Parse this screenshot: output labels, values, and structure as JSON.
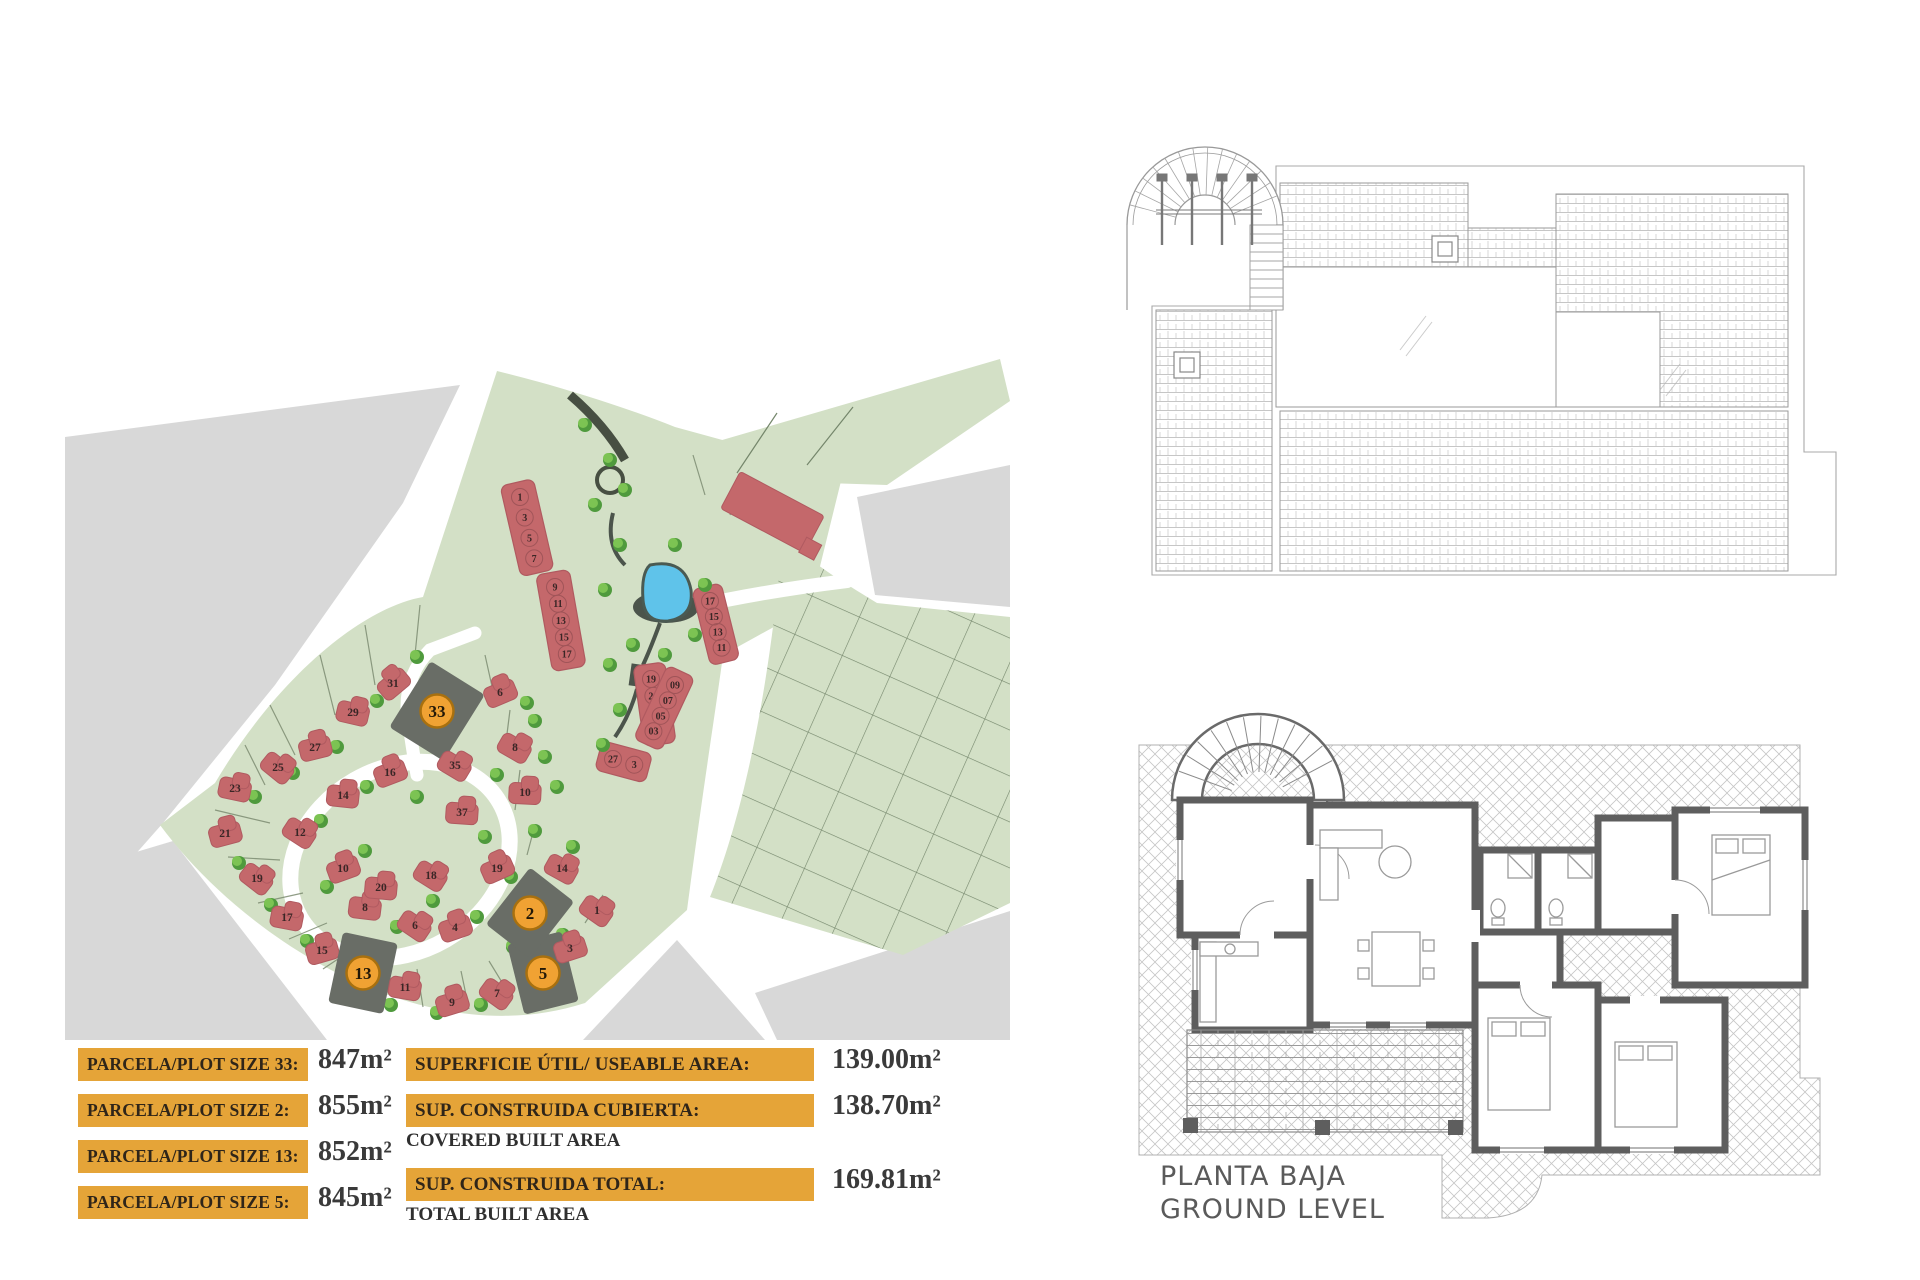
{
  "page": {
    "background": "#ffffff"
  },
  "site_plan": {
    "colors": {
      "green": "#d3e0c6",
      "gray": "#d8d8d8",
      "road": "#ffffff",
      "house": "#c4686b",
      "house_edge": "#b05a60",
      "tree_dark": "#4f9a3d",
      "tree_light": "#7cc353",
      "pond": "#5fc3ea",
      "pond_rim": "#4b544b",
      "dark_plot": "#696d66",
      "marker": "#f0a233",
      "marker_border": "#a8700f",
      "parcel_line": "#7d8c72"
    },
    "highlighted_plots": [
      "33",
      "2",
      "13",
      "5"
    ],
    "plots": [
      {
        "num": "31",
        "x": 328,
        "y": 328
      },
      {
        "num": "29",
        "x": 288,
        "y": 357
      },
      {
        "num": "27",
        "x": 250,
        "y": 392
      },
      {
        "num": "25",
        "x": 213,
        "y": 412
      },
      {
        "num": "23",
        "x": 170,
        "y": 433
      },
      {
        "num": "21",
        "x": 160,
        "y": 478
      },
      {
        "num": "19",
        "x": 192,
        "y": 523
      },
      {
        "num": "17",
        "x": 222,
        "y": 562
      },
      {
        "num": "15",
        "x": 257,
        "y": 595
      },
      {
        "num": "13",
        "x": 298,
        "y": 618,
        "hl": true,
        "rot": 12
      },
      {
        "num": "11",
        "x": 340,
        "y": 632
      },
      {
        "num": "9",
        "x": 387,
        "y": 647
      },
      {
        "num": "7",
        "x": 432,
        "y": 638
      },
      {
        "num": "5",
        "x": 478,
        "y": 618,
        "hl": true,
        "rot": -14
      },
      {
        "num": "3",
        "x": 505,
        "y": 593
      },
      {
        "num": "1",
        "x": 532,
        "y": 555
      },
      {
        "num": "2",
        "x": 465,
        "y": 558,
        "hl": true,
        "rot": 38
      },
      {
        "num": "4",
        "x": 390,
        "y": 572
      },
      {
        "num": "6",
        "x": 350,
        "y": 570
      },
      {
        "num": "8",
        "x": 300,
        "y": 552
      },
      {
        "num": "10",
        "x": 278,
        "y": 513
      },
      {
        "num": "12",
        "x": 235,
        "y": 477
      },
      {
        "num": "14",
        "x": 278,
        "y": 440
      },
      {
        "num": "16",
        "x": 325,
        "y": 417
      },
      {
        "num": "18",
        "x": 366,
        "y": 520
      },
      {
        "num": "20",
        "x": 316,
        "y": 532
      },
      {
        "num": "33",
        "x": 372,
        "y": 356,
        "hl": true,
        "rot": 32
      },
      {
        "num": "35",
        "x": 390,
        "y": 410
      },
      {
        "num": "37",
        "x": 397,
        "y": 457
      },
      {
        "num": "6",
        "x": 435,
        "y": 337
      },
      {
        "num": "8",
        "x": 450,
        "y": 392
      },
      {
        "num": "10",
        "x": 460,
        "y": 437
      },
      {
        "num": "19",
        "x": 432,
        "y": 513
      },
      {
        "num": "14",
        "x": 497,
        "y": 513
      }
    ],
    "terrace_blocks": [
      {
        "x": 455,
        "y": 142,
        "angle": 77,
        "pitch": 21,
        "w": 34,
        "units": [
          "1",
          "3",
          "5",
          "7"
        ]
      },
      {
        "x": 490,
        "y": 232,
        "angle": 80,
        "pitch": 17,
        "w": 34,
        "units": [
          "9",
          "11",
          "13",
          "15",
          "17"
        ]
      },
      {
        "x": 586,
        "y": 324,
        "angle": 82,
        "pitch": 17,
        "w": 32,
        "units": [
          "19",
          "21",
          "23",
          "25"
        ]
      },
      {
        "x": 645,
        "y": 246,
        "angle": 76,
        "pitch": 16,
        "w": 30,
        "units": [
          "17",
          "15",
          "13",
          "11"
        ]
      },
      {
        "x": 610,
        "y": 330,
        "angle": 115,
        "pitch": 17,
        "w": 30,
        "units": [
          "09",
          "07",
          "05",
          "03"
        ]
      },
      {
        "x": 548,
        "y": 404,
        "angle": 15,
        "pitch": 22,
        "w": 30,
        "units": [
          "27",
          "3"
        ]
      }
    ]
  },
  "legend": {
    "panel_color": "#e5a438",
    "label_color": "#2f2519",
    "value_color": "#3a3a3a",
    "left_rows": [
      {
        "label": "PARCELA/PLOT SIZE 33:",
        "value": "847m²"
      },
      {
        "label": "PARCELA/PLOT SIZE 2:",
        "value": "855m²"
      },
      {
        "label": "PARCELA/PLOT SIZE 13:",
        "value": "852m²"
      },
      {
        "label": "PARCELA/PLOT SIZE 5:",
        "value": "845m²"
      }
    ],
    "right_rows": [
      {
        "label": "SUPERFICIE ÚTIL/ USEABLE AREA:",
        "caption": "",
        "value": "139.00m²"
      },
      {
        "label": "SUP. CONSTRUIDA CUBIERTA:",
        "caption": "COVERED BUILT AREA",
        "value": "138.70m²"
      },
      {
        "label": "SUP. CONSTRUIDA TOTAL:",
        "caption": "TOTAL BUILT AREA",
        "value": "169.81m²"
      }
    ]
  },
  "plans": {
    "ground": {
      "title_line1": "PLANTA BAJA",
      "title_line2": "GROUND LEVEL"
    }
  }
}
